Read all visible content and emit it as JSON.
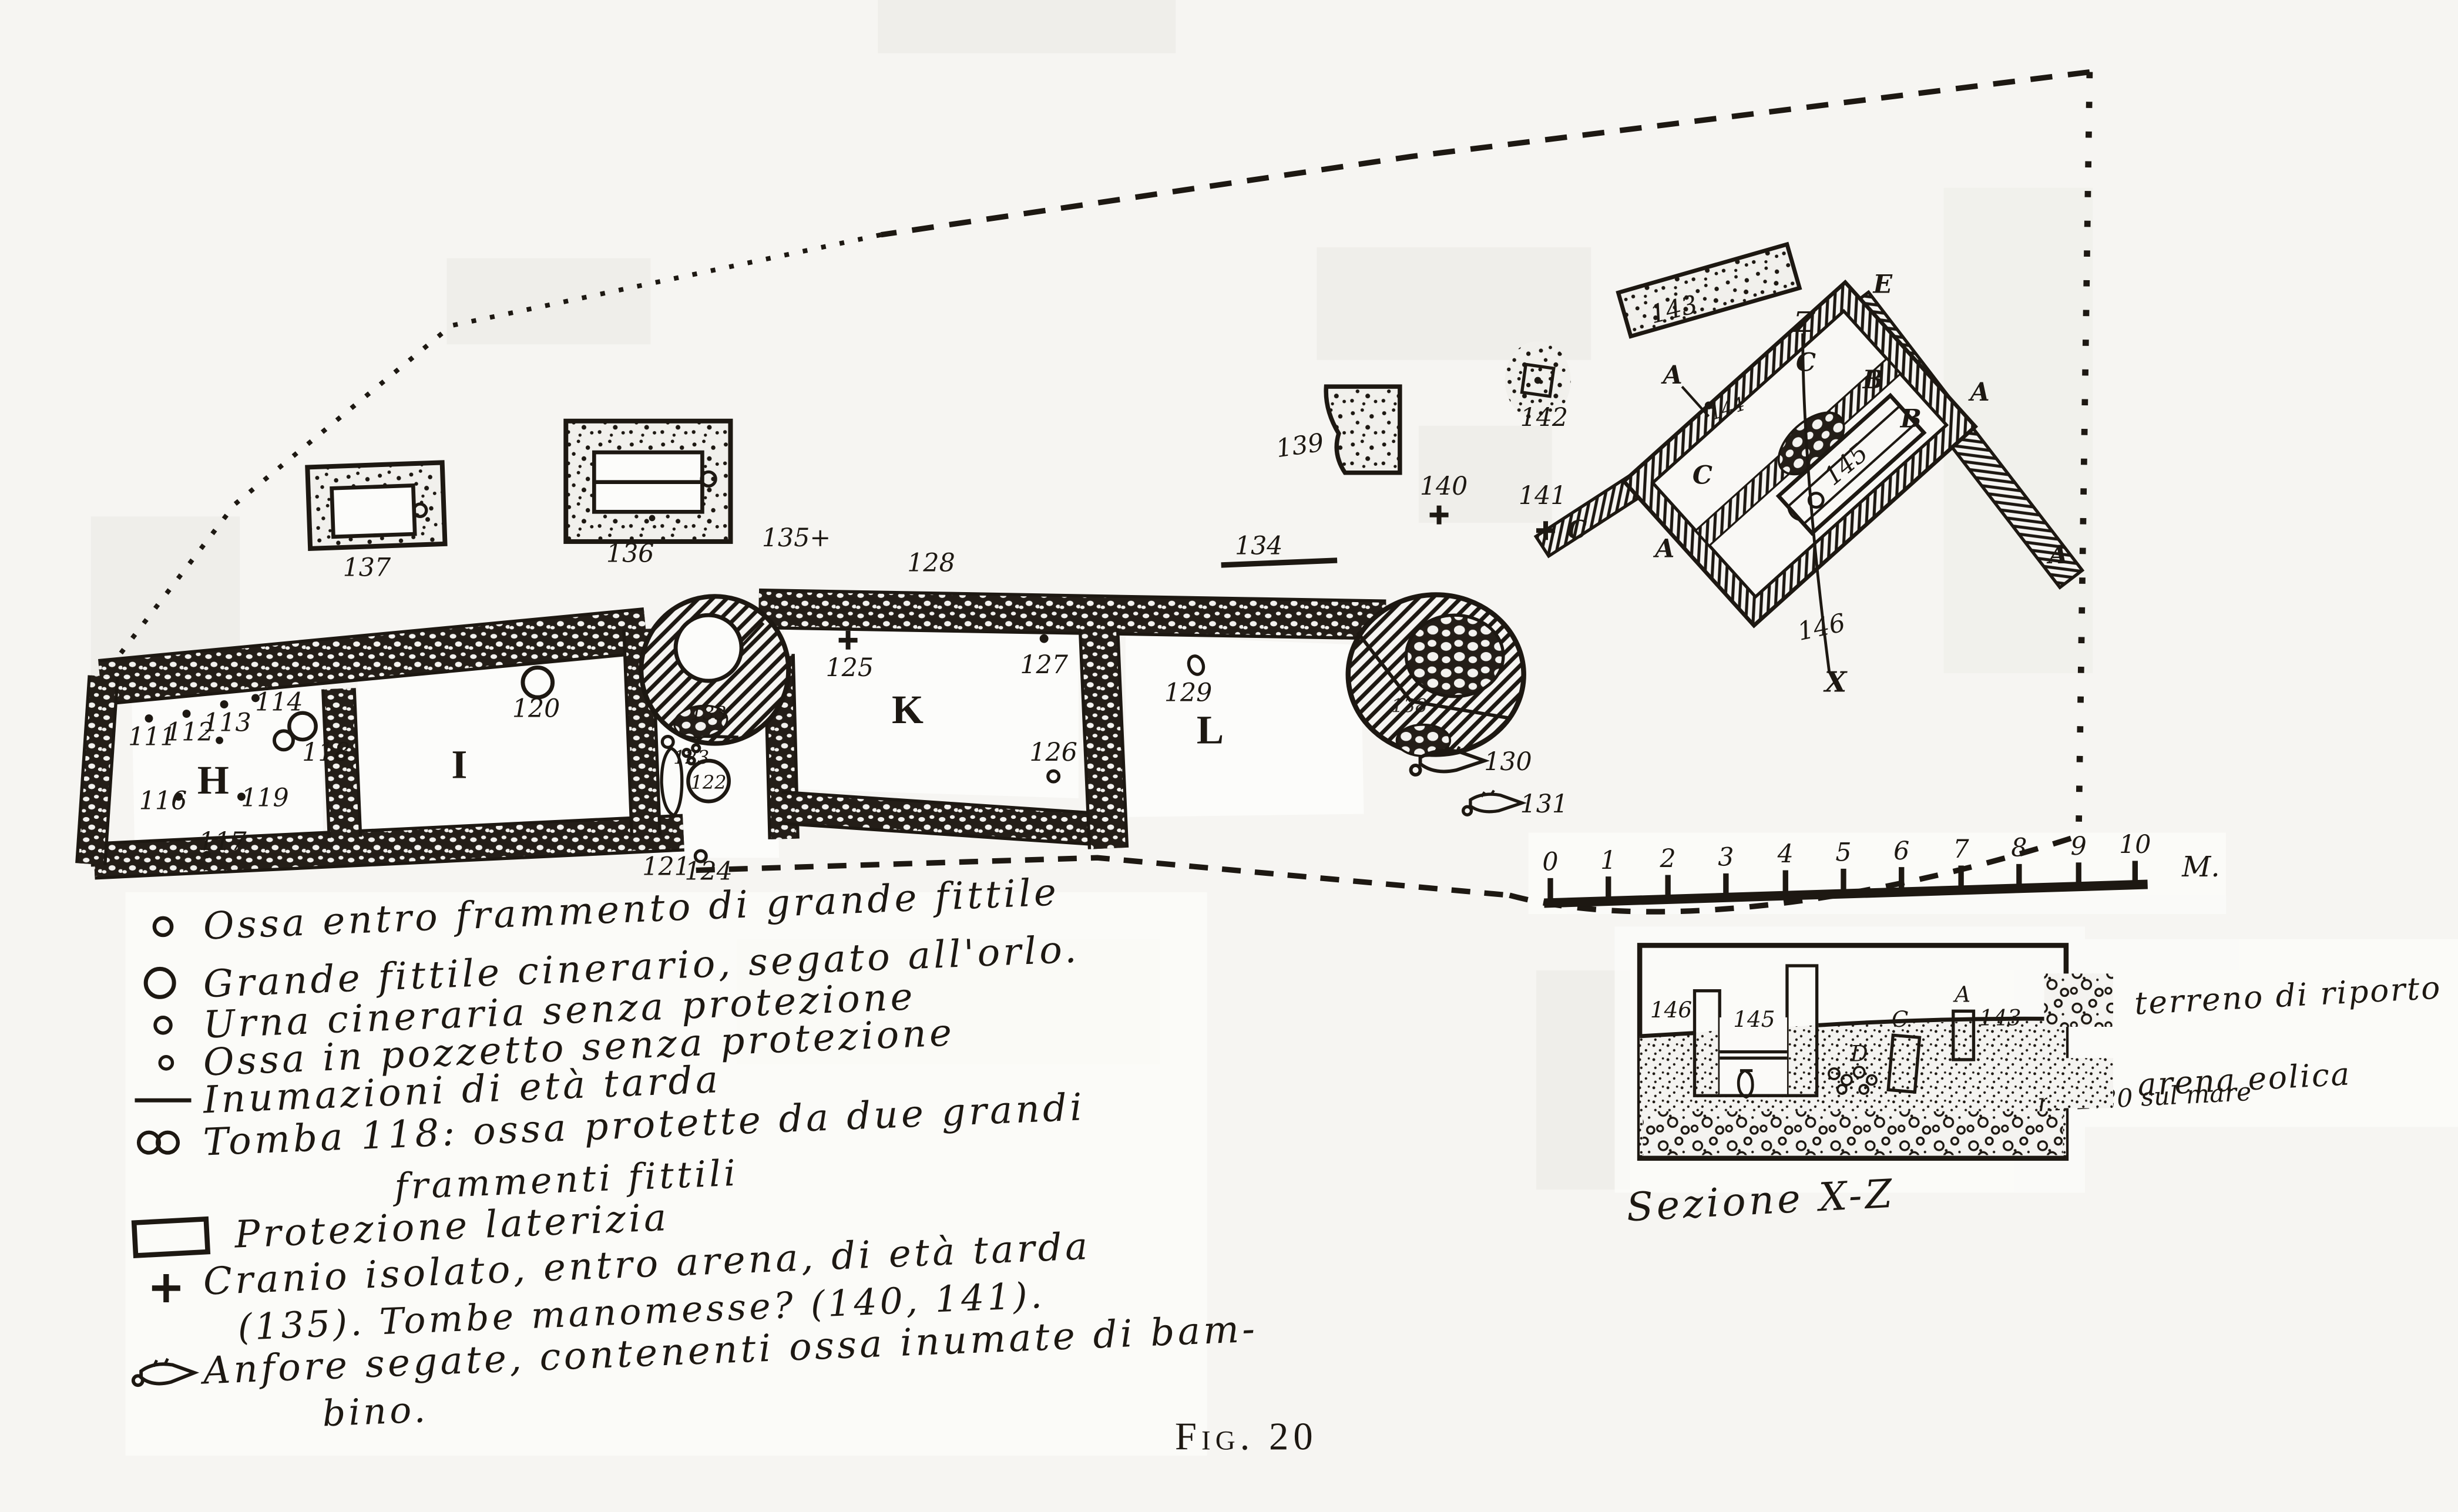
{
  "figure": {
    "caption": "Fig. 20"
  },
  "plan": {
    "rooms": {
      "H": "H",
      "I": "I",
      "K": "K",
      "L": "L"
    },
    "letters": {
      "A": "A",
      "B": "B",
      "C": "C",
      "D": "D",
      "E": "E",
      "X": "X",
      "Z": "Z"
    },
    "tombs": {
      "111": "111",
      "112": "112",
      "113": "113",
      "114": "114",
      "116": "116",
      "117": "117",
      "118": "118",
      "119": "119",
      "120": "120",
      "121": "121",
      "122": "122",
      "123": "123",
      "124": "124",
      "125": "125",
      "126": "126",
      "127": "127",
      "128": "128",
      "129": "129",
      "130": "130",
      "131": "131",
      "133": "133",
      "134": "134",
      "135": "135+",
      "136": "136",
      "137": "137",
      "138": "138",
      "139": "139",
      "140": "140",
      "141": "141",
      "142": "142",
      "143": "143",
      "144": "144",
      "145": "145",
      "146": "146"
    }
  },
  "scale_bar": {
    "ticks": [
      "0",
      "1",
      "2",
      "3",
      "4",
      "5",
      "6",
      "7",
      "8",
      "9",
      "10"
    ],
    "unit": "M."
  },
  "section": {
    "title": "Sezione X-Z",
    "elevation": "m. 2.20 sul mare",
    "labels": {
      "143": "143",
      "145": "145",
      "146": "146",
      "A": "A",
      "C": "C",
      "D": "D"
    },
    "legend": [
      {
        "swatch": "coarse-dotted-terrain-swatch",
        "label": "terreno di riporto"
      },
      {
        "swatch": "fine-dotted-sand-swatch",
        "label": "arena eolica"
      }
    ]
  },
  "legend": {
    "items": [
      {
        "symbol": "small-circle-icon",
        "text": "Ossa entro frammento di grande fittile"
      },
      {
        "symbol": "large-circle-icon",
        "text": "Grande fittile cinerario, segato all'orlo."
      },
      {
        "symbol": "small-circle-icon",
        "text": "Urna cineraria senza protezione"
      },
      {
        "symbol": "tiny-circle-icon",
        "text": "Ossa in pozzetto senza protezione"
      },
      {
        "symbol": "line-icon",
        "text": "Inumazioni di età tarda"
      },
      {
        "symbol": "double-circle-icon",
        "text": "Tomba 118: ossa protette da due grandi",
        "text2": "frammenti fittili"
      },
      {
        "symbol": "rectangle-icon",
        "text": "Protezione laterizia"
      },
      {
        "symbol": "cross-icon",
        "text": "Cranio isolato, entro arena, di età tarda",
        "text2": "(135). Tombe manomesse? (140, 141)."
      },
      {
        "symbol": "amphora-icon",
        "text": "Anfore segate, contenenti ossa inumate di bam-",
        "text2": "bino."
      }
    ]
  },
  "colors": {
    "ink": "#1d1812",
    "paper": "#f6f5f2"
  }
}
